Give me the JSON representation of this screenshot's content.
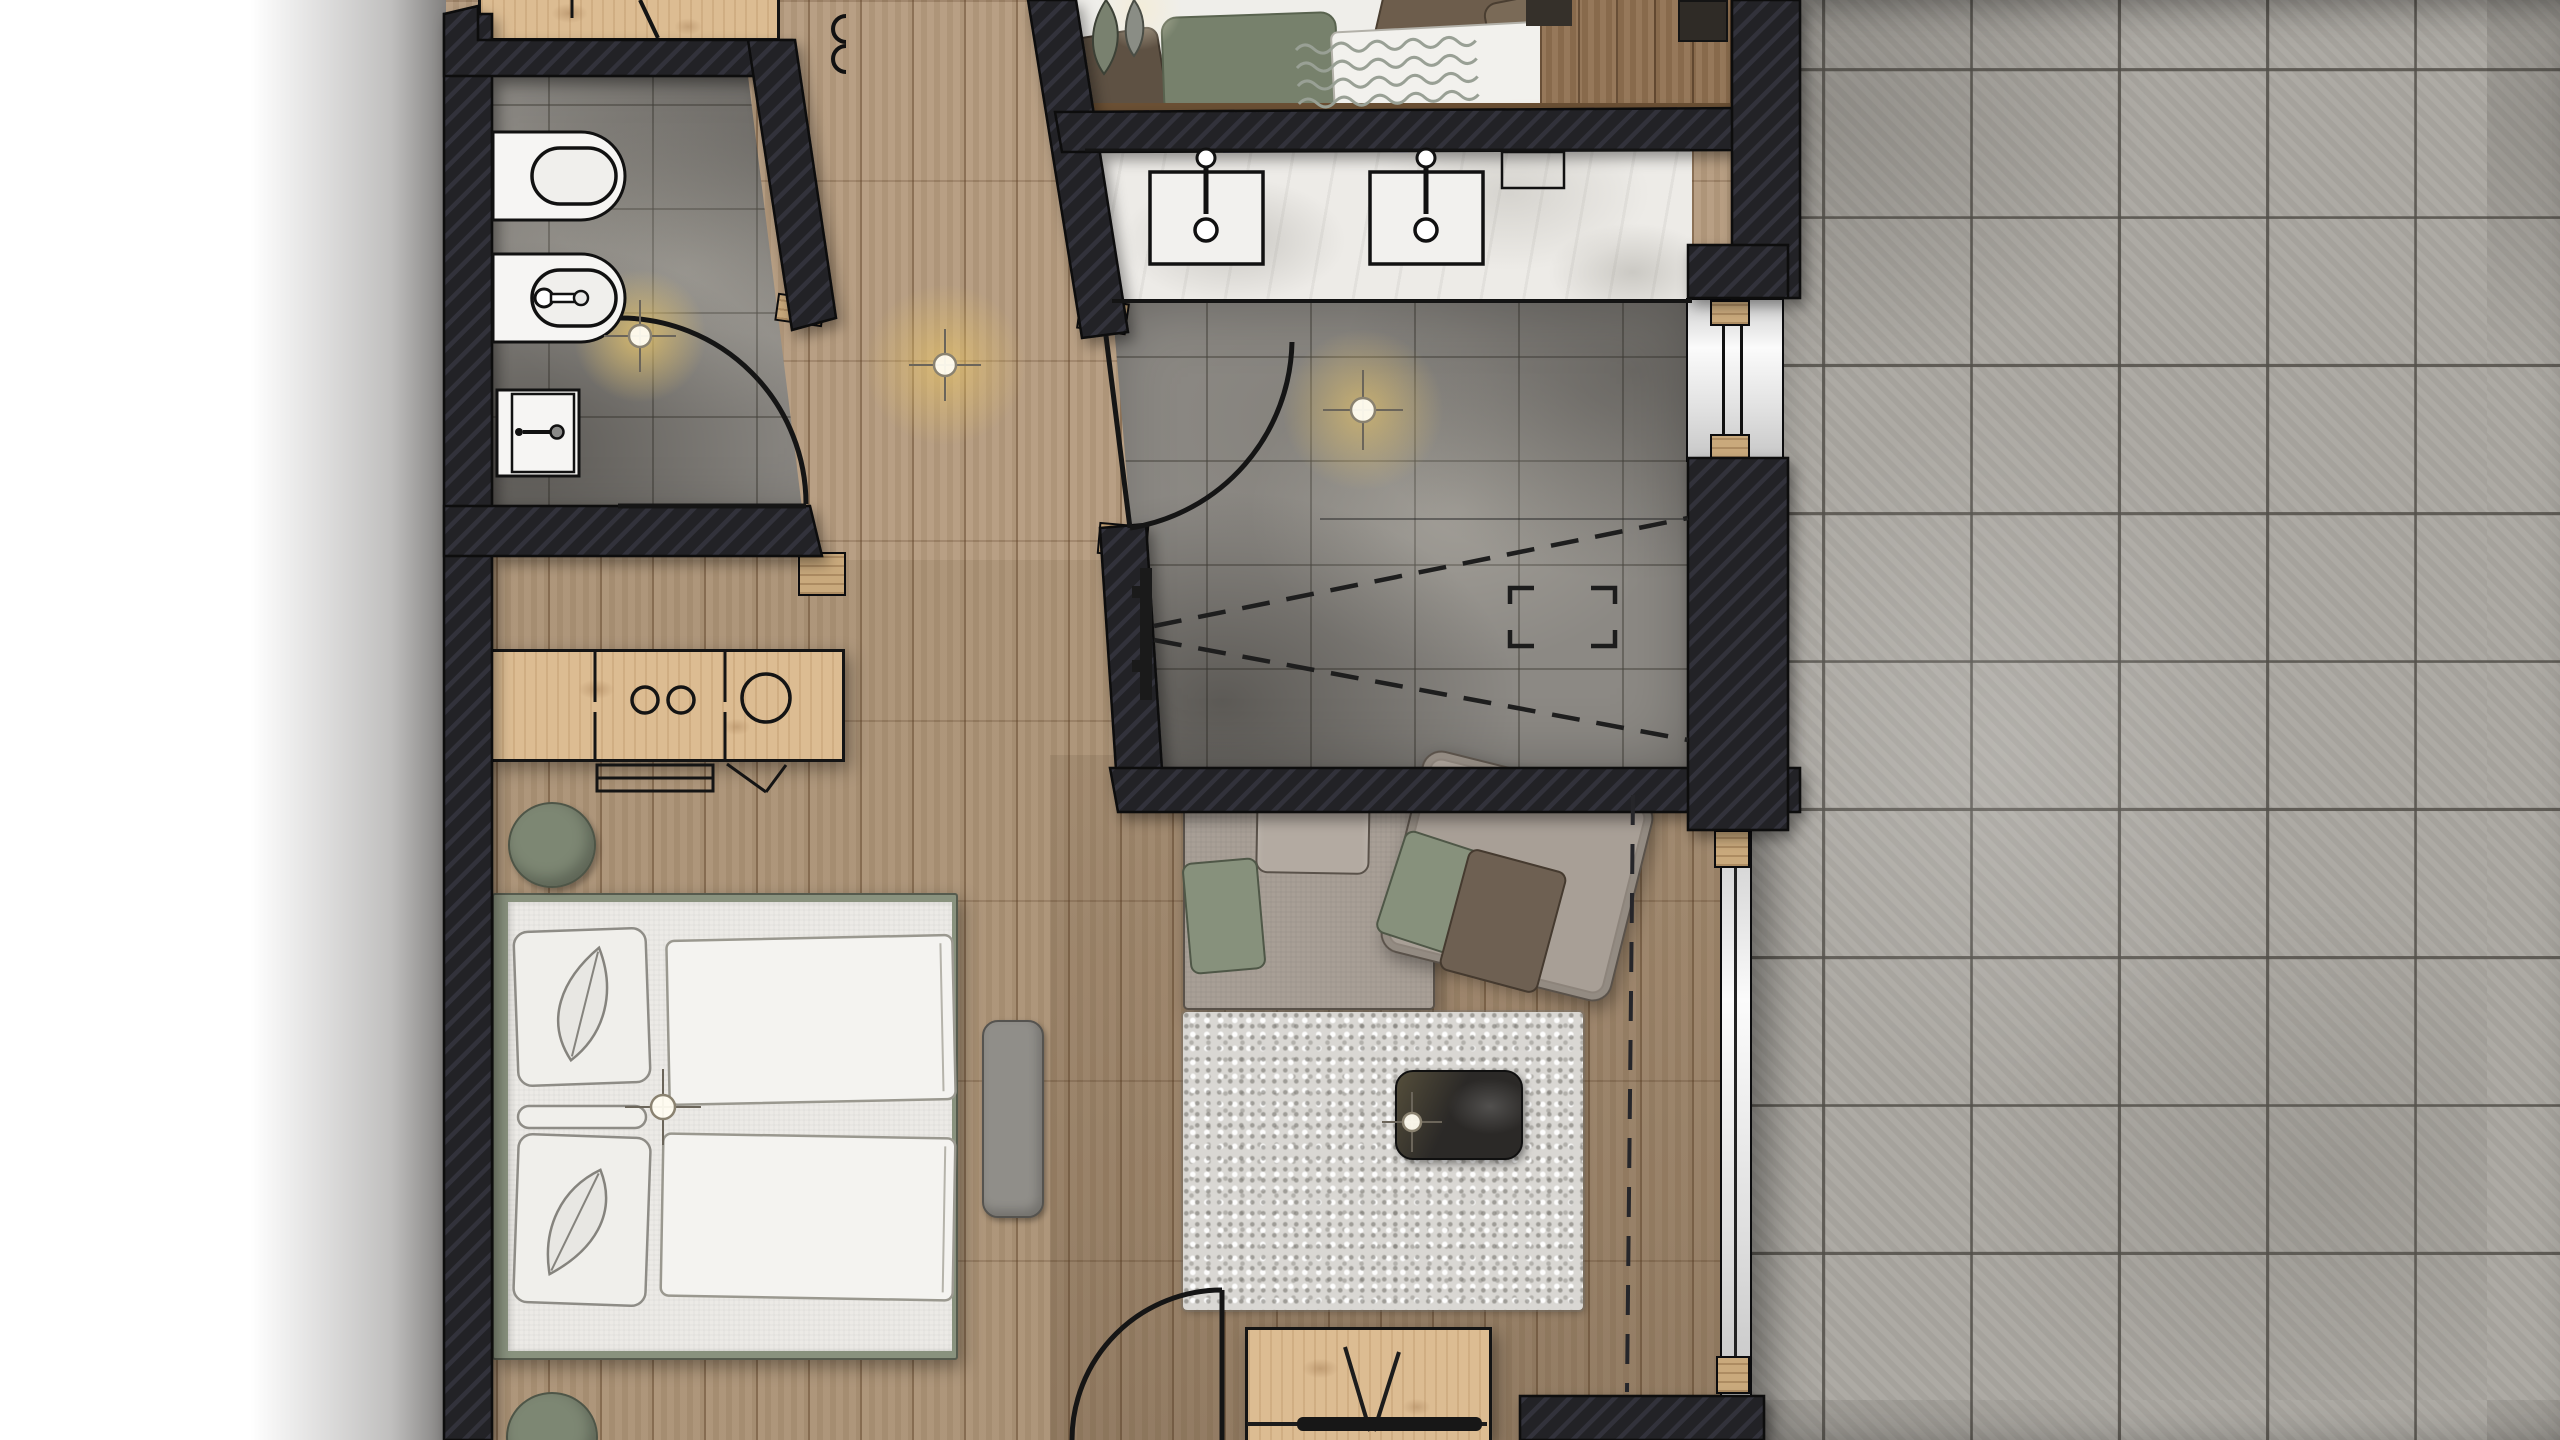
{
  "document": {
    "kind": "architectural-floor-plan-render",
    "view": "top-down",
    "visible_text": []
  },
  "palette": {
    "bg": "#ffffff",
    "outline": "#0c0c0e",
    "wall": "#232327",
    "wall_stripe": "#33333b",
    "wood_hall": "#b49a7d",
    "wood_line": "#6e4f33",
    "wood_cabinet": "#dcbc92",
    "wood_strip_dark": "#8f7050",
    "wood_jamb": "#c9a97c",
    "tile_bath": "#8c8984",
    "tile_grout": "#5b5851",
    "tile_terrace": "#aaa7a1",
    "terrace_grout": "#74716b",
    "marble": "#edebe7",
    "fixture_white": "#f6f5f3",
    "bed_frame": "#89927e",
    "mattress": "#eceae6",
    "duvet": "#f4f3f0",
    "pillow": "#f0efeb",
    "pouf": "#7d8773",
    "bench_gray": "#908e89",
    "sofa": "#a89f96",
    "sofa_light": "#b3aaa1",
    "cushion_green": "#87917c",
    "cushion_brown": "#6e6052",
    "rug": "#d9d7d3",
    "table_dark": "#2b2927",
    "tv_black": "#171717",
    "sheet": "#efeeea",
    "towel_wave": "#99a095",
    "pillow_brown_dark": "#5e5143",
    "pillow_brown": "#6d5d4c",
    "pillow_brown2": "#7a6a57",
    "plant_green": "#79816f",
    "cushion_sage": "#77816c",
    "glow": "#eec968",
    "window_white": "#fbfbfb"
  },
  "rooms": [
    {
      "id": "wc-bathroom",
      "fixtures": [
        "toilet",
        "bidet",
        "wall-sink",
        "ceiling-light",
        "door-swing"
      ]
    },
    {
      "id": "hallway",
      "fixtures": [
        "ceiling-light",
        "wall-hooks"
      ]
    },
    {
      "id": "shower-bathroom",
      "fixtures": [
        "vanity-counter",
        "sink-left",
        "sink-right",
        "amenity-tray",
        "shower-rail",
        "shower-spray-dashes",
        "floor-marker",
        "ceiling-light",
        "door-swing",
        "window"
      ]
    },
    {
      "id": "bedroom-living-area",
      "fixtures": [
        "double-bed",
        "pillows",
        "duvets",
        "poufs",
        "side-bench",
        "minibar-cabinet",
        "luggage-rack",
        "sofa",
        "shag-rug",
        "coffee-table",
        "tv-sideboard",
        "entry-door-swing",
        "curtain-track-dashes",
        "sliding-glass-door",
        "ceiling-lights"
      ]
    },
    {
      "id": "adjacent-room-top",
      "fixtures": [
        "bed-with-cushions",
        "wavy-towel",
        "plant",
        "wood-floor-strip"
      ]
    },
    {
      "id": "adjacent-room-top-left",
      "fixtures": [
        "wardrobe-cabinet"
      ]
    },
    {
      "id": "terrace",
      "fixtures": [
        "stone-tiles"
      ]
    }
  ],
  "lights": {
    "count": 5,
    "style": "crosshair-symbol-with-warm-glow"
  }
}
